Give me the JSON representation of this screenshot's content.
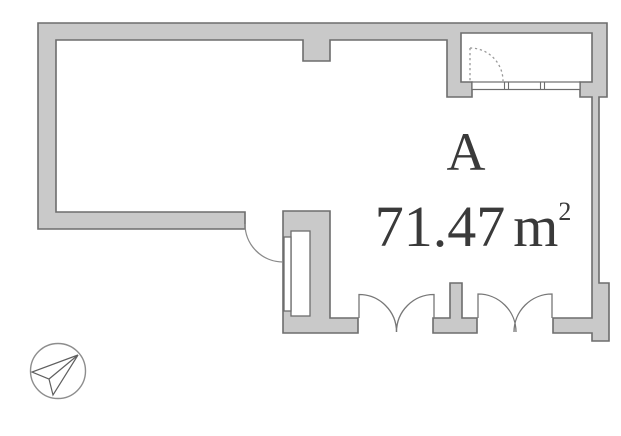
{
  "floor_plan": {
    "unit_label": "A",
    "area_value": "71.47",
    "area_unit": "m",
    "area_superscript": "2",
    "features": {
      "entry_door": "dashed-door-swing-arc",
      "window": "triple-pane-window-band",
      "interior_door": "single-door-swing-arc",
      "balcony_doors": "two-pairs-of-french-door-arcs",
      "shaft": "pipe-shaft-column"
    }
  },
  "compass": {
    "icon": "compass-north-arrow-icon",
    "direction": "upper-right"
  },
  "colors": {
    "background": "#ffffff",
    "wall_fill": "#c9c9c9",
    "wall_stroke": "#6d6d6d",
    "text": "#3a3a3a",
    "arc_stroke": "#8a8a8a",
    "compass_stroke": "#8d8d8d"
  }
}
